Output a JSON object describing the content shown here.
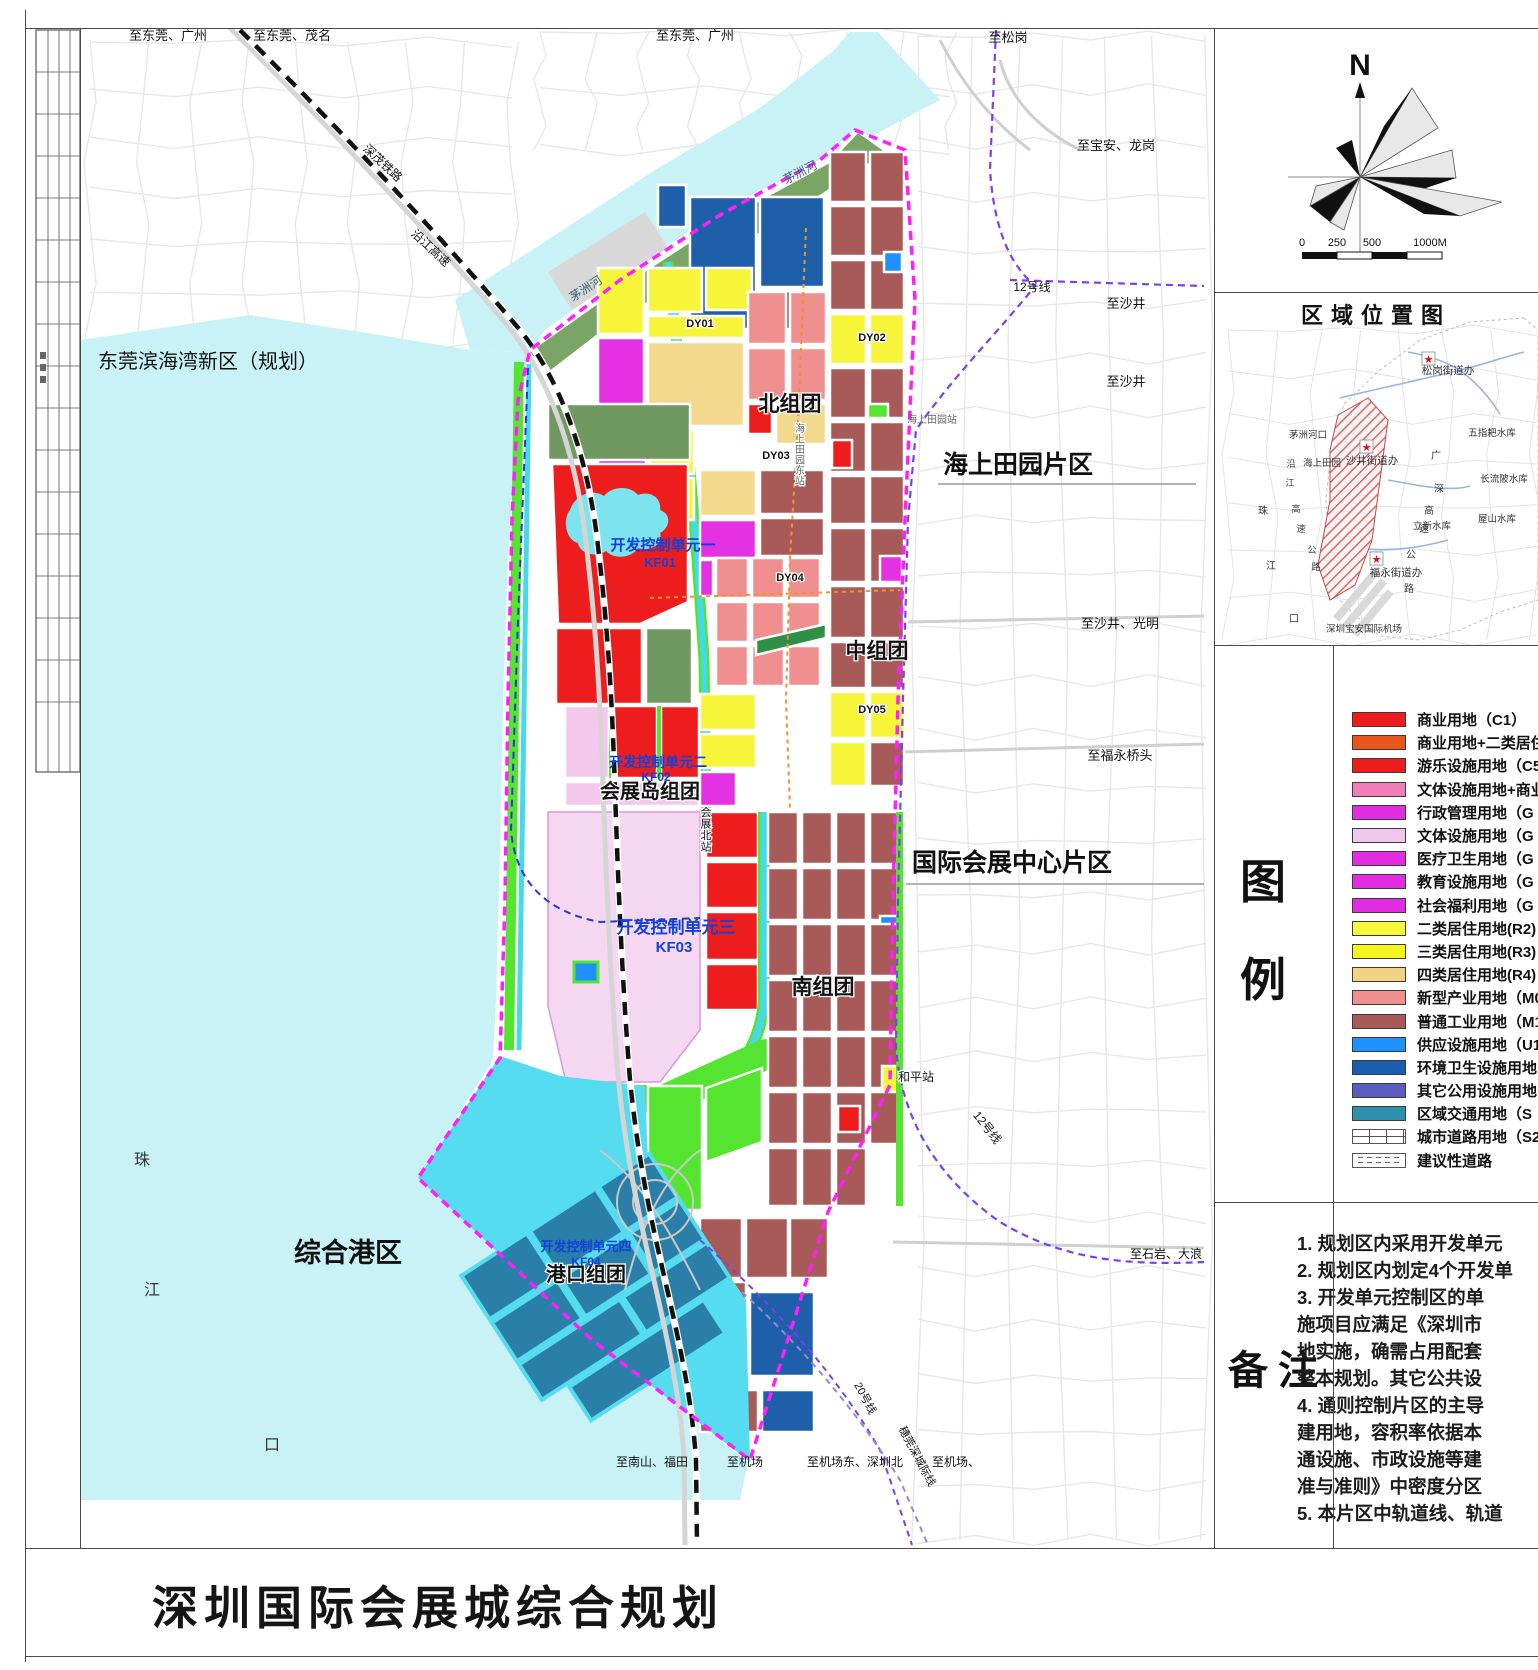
{
  "sheet": {
    "title": "深圳国际会展城综合规划"
  },
  "compass": {
    "north_label": "N"
  },
  "scalebar": {
    "ticks": [
      "0",
      "250",
      "500",
      "1000M"
    ]
  },
  "location_map": {
    "title": "区域位置图",
    "labels": {
      "songgang_office": "松岗街道办",
      "shajing_office": "沙井街道办",
      "fuyong_office": "福永街道办",
      "wuzhipa_reservoir": "五指耙水库",
      "changliupi_reservoir": "长流陂水库",
      "lixin_reservoir": "立新水库",
      "wushan_reservoir": "屋山水库",
      "maozhou_estuary": "茅洲河口",
      "haishang_tianyuan": "海上田园",
      "airport": "深圳宝安国际机场",
      "zhu": "珠",
      "jiang": "江",
      "kou": "口",
      "yan": "沿",
      "jiang2": "江",
      "gao": "高",
      "su": "速",
      "gong": "公",
      "lu": "路",
      "guang": "广",
      "shen": "深",
      "gao2": "高",
      "su2": "速",
      "gong2": "公",
      "lu2": "路"
    }
  },
  "legend": {
    "title_chars": [
      "图",
      "例"
    ],
    "items": [
      {
        "label": "商业用地（C1）",
        "color": "#ee1c1c",
        "type": "fill"
      },
      {
        "label": "商业用地+二类居住",
        "color": "#e8561e",
        "type": "fill"
      },
      {
        "label": "游乐设施用地（C5",
        "color": "#ee1c1c",
        "type": "fill"
      },
      {
        "label": "文体设施用地+商业",
        "color": "#f07eb8",
        "type": "fill"
      },
      {
        "label": "行政管理用地（G",
        "color": "#e22ce2",
        "type": "fill"
      },
      {
        "label": "文体设施用地（G",
        "color": "#f0c6ee",
        "type": "fill"
      },
      {
        "label": "医疗卫生用地（G",
        "color": "#e22ce2",
        "type": "fill"
      },
      {
        "label": "教育设施用地（G",
        "color": "#e22ce2",
        "type": "fill"
      },
      {
        "label": "社会福利用地（G",
        "color": "#e22ce2",
        "type": "fill"
      },
      {
        "label": "二类居住用地(R2)",
        "color": "#f8f83a",
        "type": "fill"
      },
      {
        "label": "三类居住用地(R3)",
        "color": "#f4f41e",
        "type": "fill"
      },
      {
        "label": "四类居住用地(R4)",
        "color": "#f2d283",
        "type": "fill"
      },
      {
        "label": "新型产业用地（M0",
        "color": "#ef8f8f",
        "type": "fill"
      },
      {
        "label": "普通工业用地（M1",
        "color": "#a85a58",
        "type": "fill"
      },
      {
        "label": "供应设施用地（U1",
        "color": "#1e90ff",
        "type": "fill"
      },
      {
        "label": "环境卫生设施用地",
        "color": "#1a5cb0",
        "type": "fill"
      },
      {
        "label": "其它公用设施用地",
        "color": "#5c5cc0",
        "type": "fill"
      },
      {
        "label": "区域交通用地（S",
        "color": "#2e8fae",
        "type": "fill"
      },
      {
        "label": "城市道路用地（S2",
        "color": "",
        "type": "road"
      },
      {
        "label": "建议性道路",
        "color": "",
        "type": "dashed-road"
      }
    ]
  },
  "notes": {
    "title": "备注",
    "lines": [
      "1. 规划区内采用开发单元",
      "2. 规划区内划定4个开发单",
      "3. 开发单元控制区的单",
      "施项目应满足《深圳市",
      "地实施，确需占用配套",
      "整本规划。其它公共设",
      "4. 通则控制片区的主导",
      "建用地，容积率依据本",
      "通设施、市政设施等建",
      "准与准则》中密度分区",
      "5. 本片区中轨道线、轨道"
    ]
  },
  "map": {
    "labels": {
      "to_dg_gz1": "至东莞、广州",
      "to_dg_mm": "至东莞、茂名",
      "to_dg_gz2": "至东莞、广州",
      "to_songgang": "至松岗",
      "to_baoan_longgang": "至宝安、龙岗",
      "to_shajing1": "至沙井",
      "to_shajing2": "至沙井",
      "to_shajing_guangming": "至沙井、光明",
      "to_fuyong_qiaotou": "至福永桥头",
      "to_shiyan_dalang": "至石岩、大浪",
      "to_nanshan_futian": "至南山、福田",
      "to_jichang": "至机场",
      "to_jichangdong_szb": "至机场东、深圳北",
      "to_jichang2": "至机场、",
      "dongguan_new_area": "东莞滨海湾新区（规划）",
      "haishangtianyuan_district": "海上田园片区",
      "exhibition_center_district": "国际会展中心片区",
      "port_district": "综合港区",
      "north_group": "北组团",
      "middle_group": "中组团",
      "south_group": "南组团",
      "exhibition_island_group": "会展岛组团",
      "port_group": "港口组团",
      "kf01_name": "开发控制单元一",
      "kf01_code": "KF01",
      "kf02_name": "开发控制单元二",
      "kf02_code": "KF02",
      "kf03_name": "开发控制单元三",
      "kf03_code": "KF03",
      "kf04_name": "开发控制单元四",
      "kf04_code": "KF04",
      "dy01": "DY01",
      "dy02": "DY02",
      "dy03": "DY03",
      "dy04": "DY04",
      "dy05": "DY05",
      "st_huizhanbei": "会展北站",
      "st_heping": "和平站",
      "st_hsty": "海上田园站",
      "st_hsty_east": "海上田园东站",
      "line12_a": "12号线",
      "line12_b": "12号线",
      "line20": "20号线",
      "intercity": "穗莞深城际线",
      "shenmao_railway": "深茂铁路",
      "yanjiang_expwy": "沿江高速",
      "maozhou_river1": "茅洲河",
      "maozhou_river2": "茅洲河",
      "zhu": "珠",
      "jiang": "江",
      "kou": "口"
    }
  },
  "colors": {
    "boundary": "#ff1ffb",
    "water": "#c9f2f7",
    "port_water": "#55dcf0",
    "canal": "#45d9ea",
    "commercial": "#ee1d1d",
    "industry": "#a85a58",
    "residential_r2": "#f7f53a",
    "residential_r4": "#f2d98e",
    "new_industry": "#ef8f8f",
    "gic_magenta": "#e431e4",
    "culture_pink": "#f6d7f2",
    "green_space": "#55e531",
    "sage_green": "#6f9960",
    "dark_blue": "#1d5fa8",
    "supply_blue": "#1e90ff",
    "regional_transport": "#2a7fa8",
    "metro_purple": "#7b3ff2",
    "unit_label_blue": "#1040dd"
  }
}
